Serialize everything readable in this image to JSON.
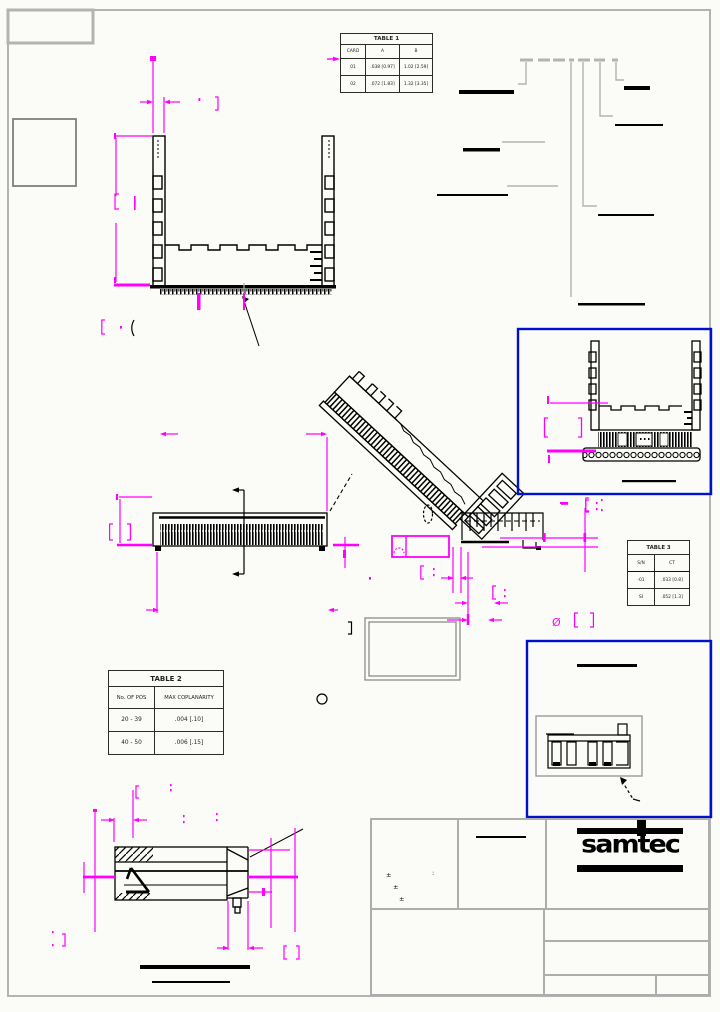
{
  "sheet": {
    "background": "#FBFBF7",
    "frame_color": "#B3B3B3"
  },
  "colors": {
    "dimension": "#FF00FF",
    "detail_border": "#0011CC",
    "drawing": "#000000",
    "leader_gray": "#B3B3B3"
  },
  "symbols": {
    "diameter": "Ø",
    "plus_minus": "±",
    "colon": ":"
  },
  "table1": {
    "title": "TABLE 1",
    "headers": [
      "CARD",
      "A",
      "B"
    ],
    "rows": [
      [
        "01",
        ".038 [0.97]",
        "1.02 [2.59]"
      ],
      [
        "02",
        ".072 [1.83]",
        "1.32 [3.35]"
      ]
    ]
  },
  "table2": {
    "title": "TABLE 2",
    "headers": [
      "No. OF POS",
      "MAX COPLANARITY"
    ],
    "rows": [
      [
        "20 - 39",
        ".004 [.10]"
      ],
      [
        "40 - 50",
        ".006 [.15]"
      ]
    ]
  },
  "table3": {
    "title": "TABLE 3",
    "headers": [
      "S/N",
      "CT"
    ],
    "rows": [
      [
        "-01",
        ".033 [0.8]"
      ],
      [
        "SI",
        ".052 [1.3]"
      ]
    ]
  },
  "logo": {
    "text": "samtec"
  }
}
